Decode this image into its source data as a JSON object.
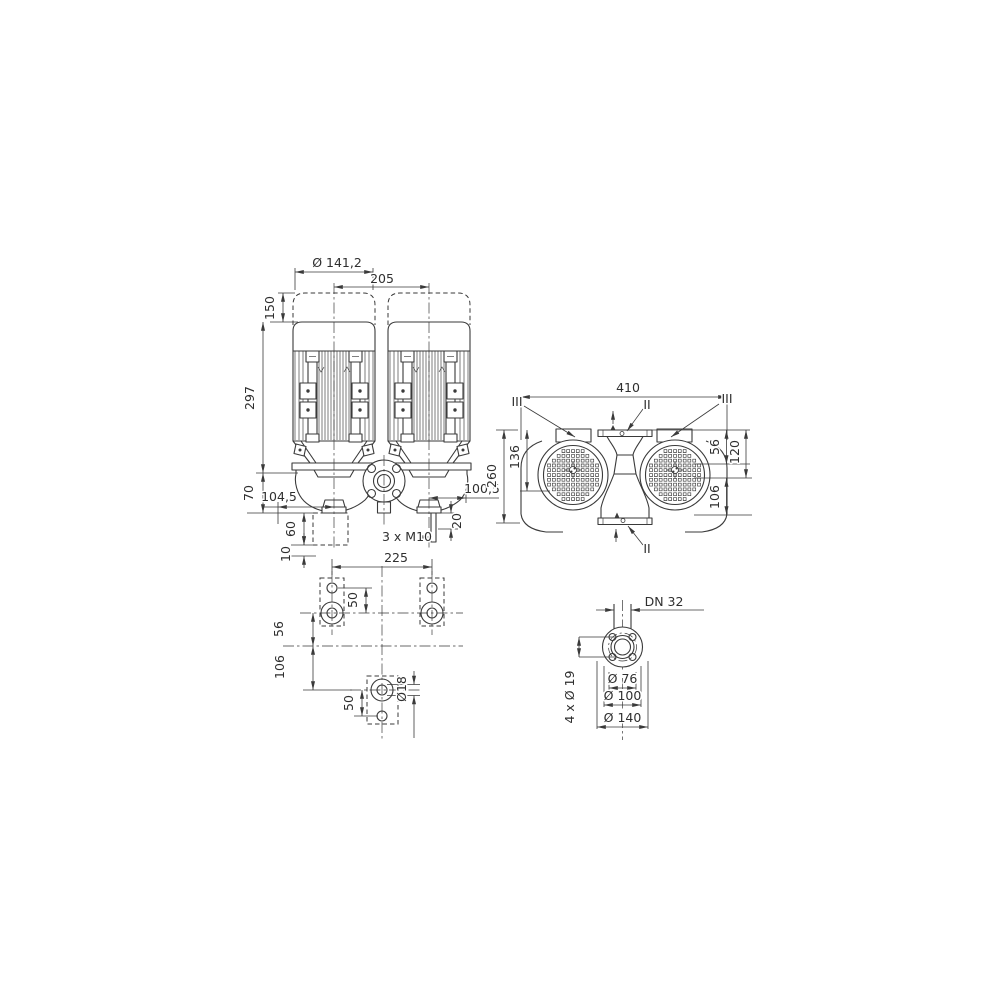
{
  "page": {
    "background": "#ffffff",
    "line_color": "#3a3a3a"
  },
  "front_view": {
    "dim_motor_diameter": "Ø 141,2",
    "dim_axis_distance": "205",
    "dim_cap_height": "150",
    "dim_motor_height": "297",
    "dim_axis_to_mounting": "70",
    "dim_left_axis_offset": "104,5",
    "dim_right_axis_offset": "100,5",
    "dim_clearance_height": "60",
    "dim_base_gap": "10",
    "dim_stud_length": "20",
    "dim_stud_thread": "3 x M10"
  },
  "top_view": {
    "dim_overall_width": "410",
    "dim_axis_offset": "136",
    "dim_overall_depth": "260",
    "dim_box_depth": "56",
    "dim_flange_to_axis": "120",
    "dim_axis_to_flange": "106",
    "label_port_top": "II",
    "label_port_bottom": "II",
    "label_terminal_left": "III",
    "label_terminal_right": "III"
  },
  "foot_view": {
    "dim_foot_spacing": "225",
    "dim_hole_offset_top": "50",
    "dim_axis_offset": "56",
    "dim_axis_to_foot": "106",
    "dim_hole_offset_bottom": "50",
    "dim_hole_diameter": "Ø18"
  },
  "flange_view": {
    "dim_nominal_diameter": "DN 32",
    "dim_bolt_holes": "4 x Ø 19",
    "dim_raised_face": "Ø 76",
    "dim_bolt_circle": "Ø 100",
    "dim_outer_diameter": "Ø 140"
  }
}
